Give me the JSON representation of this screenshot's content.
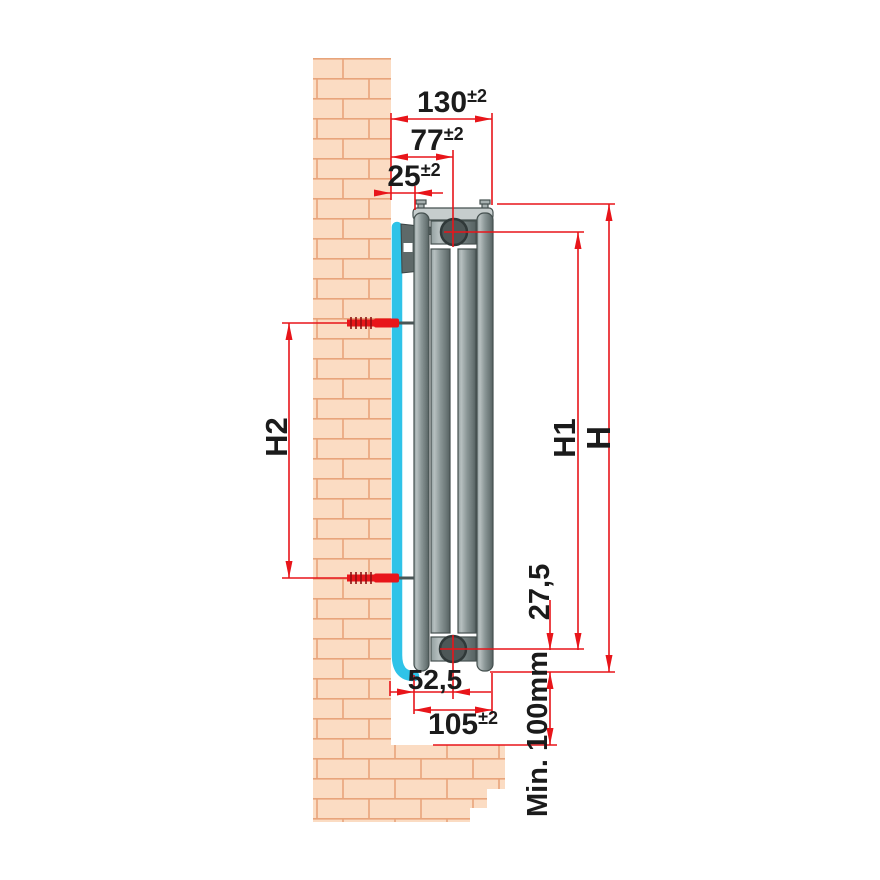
{
  "dims": {
    "d130": {
      "value": "130",
      "tol": "±2"
    },
    "d77": {
      "value": "77",
      "tol": "±2"
    },
    "d25": {
      "value": "25",
      "tol": "±2"
    },
    "d105": {
      "value": "105",
      "tol": "±2"
    },
    "d52_5": {
      "value": "52,5"
    },
    "d27_5": {
      "value": "27,5"
    },
    "h": {
      "value": "H"
    },
    "h1": {
      "value": "H1"
    },
    "h2": {
      "value": "H2"
    },
    "min_floor": {
      "value": "Min. 100mm"
    }
  },
  "colors": {
    "dimension_red": "#e8151a",
    "brick_fill": "#fbdcc3",
    "brick_mortar": "#e8a47b",
    "mounting_rail_cyan": "#2fc3e8",
    "radiator_gray": "#7d8989",
    "water_channel_gray": "#4d5757",
    "background": "#ffffff"
  }
}
